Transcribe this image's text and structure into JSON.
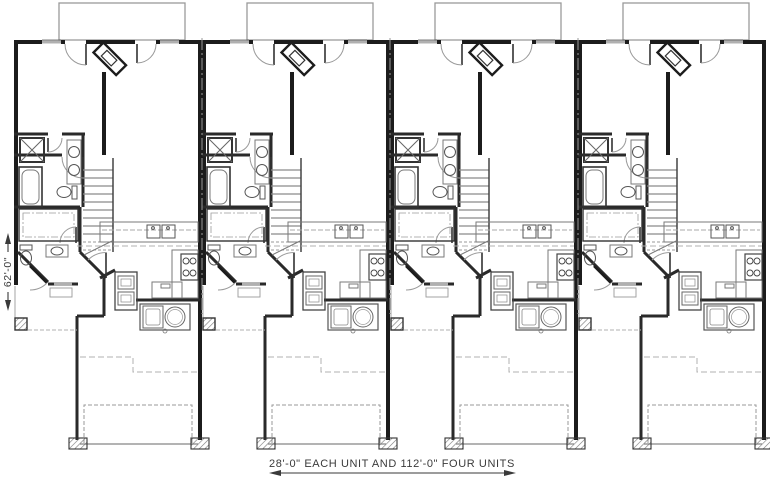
{
  "page": {
    "background": "#ffffff"
  },
  "plan": {
    "type": "floor-plan",
    "units": [
      {
        "label": "unit-1"
      },
      {
        "label": "unit-2"
      },
      {
        "label": "unit-3"
      },
      {
        "label": "unit-4"
      }
    ],
    "unit_width_px": 188,
    "origin_x_px": 14,
    "dimensions": {
      "width_label": "28'-0\" EACH UNIT AND 112'-0\" FOUR UNITS",
      "depth_label": "62'-0\""
    },
    "colors": {
      "wall": "#1c1c1c",
      "interior_wall": "#2a2a2a",
      "fixture": "#555555",
      "fixture_light": "#7a7a7a",
      "light_gray": "#b0b0b0",
      "dash_gray": "#9a9a9a",
      "text": "#3a3a3a"
    }
  }
}
